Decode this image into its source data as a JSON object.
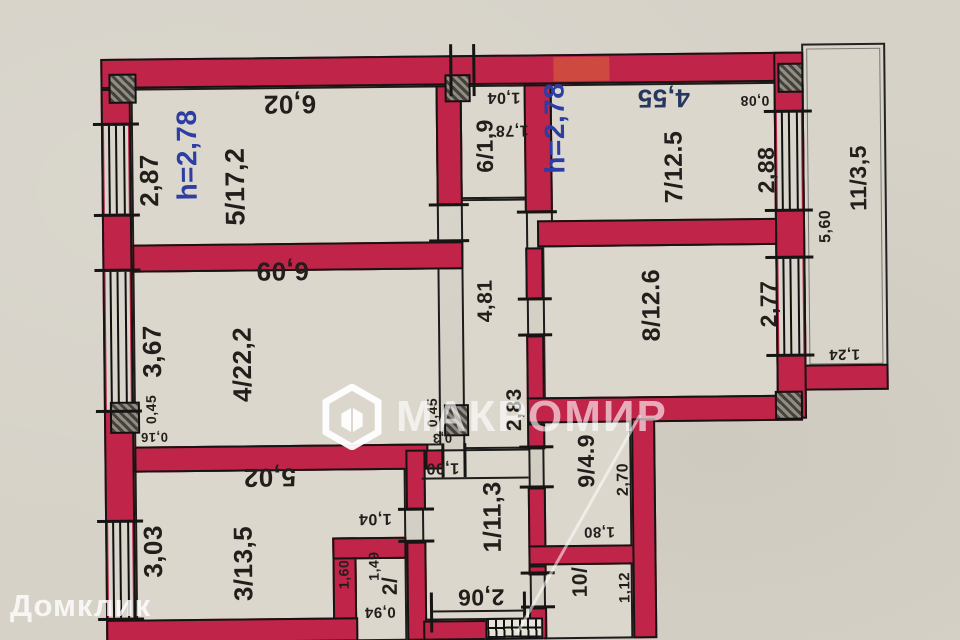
{
  "watermarks": {
    "center": "МАКРОМИР",
    "bottom_left": "Домклик"
  },
  "ceiling_height": "2,78",
  "colors": {
    "wall": "#c02449",
    "ink": "#211e1b",
    "blue": "#2c3da4",
    "navy": "#26375f",
    "paper": "#d6d2c8",
    "room": "#dbd7cc"
  },
  "rooms": [
    {
      "number": "1",
      "area": "11,3"
    },
    {
      "number": "2",
      "area": ""
    },
    {
      "number": "3",
      "area": "13,5"
    },
    {
      "number": "4",
      "area": "22,2"
    },
    {
      "number": "5",
      "area": "17,2"
    },
    {
      "number": "6",
      "area": "1,9"
    },
    {
      "number": "7",
      "area": "12.5"
    },
    {
      "number": "8",
      "area": "12.6"
    },
    {
      "number": "9",
      "area": "4.9"
    },
    {
      "number": "10",
      "area": ""
    },
    {
      "number": "11",
      "area": "3,5"
    }
  ],
  "labels": [
    {
      "name": "room-5-label",
      "text": "5/17,2",
      "x": 237,
      "y": 184,
      "rot": -90,
      "size": 27
    },
    {
      "name": "dim-room5-width",
      "text": "6,02",
      "x": 292,
      "y": 102,
      "rot": 180,
      "size": 26
    },
    {
      "name": "dim-room5-depth",
      "text": "2,87",
      "x": 151,
      "y": 177,
      "rot": -90,
      "size": 26
    },
    {
      "name": "ceiling-height-left",
      "text": "h=2,78",
      "x": 189,
      "y": 152,
      "rot": -90,
      "size": 28,
      "color": "#2c3da4"
    },
    {
      "name": "room-6-label",
      "text": "6/1,9",
      "x": 487,
      "y": 146,
      "rot": -90,
      "size": 23
    },
    {
      "name": "dim-room6-width",
      "text": "1,04",
      "x": 506,
      "y": 97,
      "rot": 180,
      "size": 16
    },
    {
      "name": "dim-room6-depth",
      "text": "1,78",
      "x": 514,
      "y": 130,
      "rot": 180,
      "size": 16
    },
    {
      "name": "ceiling-height-right",
      "text": "h=2,78",
      "x": 557,
      "y": 129,
      "rot": -90,
      "size": 28,
      "color": "#2c3da4"
    },
    {
      "name": "dim-room7-width",
      "text": "4,55",
      "x": 666,
      "y": 100,
      "rot": 180,
      "size": 26,
      "color": "#26375f"
    },
    {
      "name": "dim-0-08",
      "text": "0,08",
      "x": 757,
      "y": 104,
      "rot": 180,
      "size": 14
    },
    {
      "name": "room-7-label",
      "text": "7/12.5",
      "x": 676,
      "y": 169,
      "rot": -90,
      "size": 25
    },
    {
      "name": "dim-room7-window",
      "text": "2,88",
      "x": 768,
      "y": 173,
      "rot": -90,
      "size": 23
    },
    {
      "name": "dim-balcony-length",
      "text": "5,60",
      "x": 827,
      "y": 230,
      "rot": -90,
      "size": 16
    },
    {
      "name": "room-11-label",
      "text": "11/3,5",
      "x": 860,
      "y": 182,
      "rot": -90,
      "size": 23
    },
    {
      "name": "dim-room4-width",
      "text": "6,09",
      "x": 283,
      "y": 269,
      "rot": 180,
      "size": 26
    },
    {
      "name": "dim-room4-depth",
      "text": "3,67",
      "x": 152,
      "y": 348,
      "rot": -90,
      "size": 26
    },
    {
      "name": "room-4-label",
      "text": "4/22,2",
      "x": 242,
      "y": 362,
      "rot": -90,
      "size": 26
    },
    {
      "name": "dim-0-45-left",
      "text": "0,45",
      "x": 150,
      "y": 406,
      "rot": -90,
      "size": 14
    },
    {
      "name": "dim-0-16",
      "text": "0,16",
      "x": 153,
      "y": 434,
      "rot": 180,
      "size": 13
    },
    {
      "name": "room-8-label",
      "text": "8/12.6",
      "x": 652,
      "y": 307,
      "rot": -90,
      "size": 25
    },
    {
      "name": "dim-room8-window",
      "text": "2,77",
      "x": 769,
      "y": 307,
      "rot": -90,
      "size": 23
    },
    {
      "name": "dim-corridor-4-81",
      "text": "4,81",
      "x": 486,
      "y": 301,
      "rot": -90,
      "size": 21
    },
    {
      "name": "dim-corridor-2-83",
      "text": "2,83",
      "x": 514,
      "y": 410,
      "rot": -90,
      "size": 21
    },
    {
      "name": "dim-0-45-mid",
      "text": "0,45",
      "x": 431,
      "y": 412,
      "rot": -90,
      "size": 14
    },
    {
      "name": "dim-0-3",
      "text": "0,3",
      "x": 441,
      "y": 438,
      "rot": 180,
      "size": 13
    },
    {
      "name": "dim-1-00",
      "text": "1,00",
      "x": 441,
      "y": 467,
      "rot": 180,
      "size": 16
    },
    {
      "name": "dim-room3-width",
      "text": "5,02",
      "x": 268,
      "y": 475,
      "rot": 180,
      "size": 26
    },
    {
      "name": "dim-room3-depth",
      "text": "3,03",
      "x": 151,
      "y": 548,
      "rot": -90,
      "size": 26
    },
    {
      "name": "room-3-label",
      "text": "3/13,5",
      "x": 241,
      "y": 561,
      "rot": -90,
      "size": 26
    },
    {
      "name": "dim-1-04-door",
      "text": "1,04",
      "x": 373,
      "y": 517,
      "rot": 180,
      "size": 16
    },
    {
      "name": "dim-1-60",
      "text": "1,60",
      "x": 341,
      "y": 573,
      "rot": -90,
      "size": 14
    },
    {
      "name": "dim-1-49",
      "text": "1,49",
      "x": 371,
      "y": 565,
      "rot": -90,
      "size": 14
    },
    {
      "name": "room-2-label",
      "text": "2/",
      "x": 388,
      "y": 585,
      "rot": -90,
      "size": 21
    },
    {
      "name": "dim-0-94",
      "text": "0,94",
      "x": 377,
      "y": 611,
      "rot": 180,
      "size": 15
    },
    {
      "name": "room-1-label",
      "text": "1/11,3",
      "x": 491,
      "y": 517,
      "rot": -90,
      "size": 25
    },
    {
      "name": "dim-2-06",
      "text": "2,06",
      "x": 478,
      "y": 597,
      "rot": 180,
      "size": 23
    },
    {
      "name": "room-9-label",
      "text": "9/4.9",
      "x": 585,
      "y": 462,
      "rot": -90,
      "size": 23
    },
    {
      "name": "dim-room9-2-70",
      "text": "2,70",
      "x": 622,
      "y": 481,
      "rot": -90,
      "size": 16
    },
    {
      "name": "dim-1-80",
      "text": "1,80",
      "x": 597,
      "y": 533,
      "rot": 180,
      "size": 15
    },
    {
      "name": "room-10-label",
      "text": "10/",
      "x": 578,
      "y": 583,
      "rot": -90,
      "size": 21
    },
    {
      "name": "dim-1-12",
      "text": "1,12",
      "x": 622,
      "y": 589,
      "rot": -90,
      "size": 15
    },
    {
      "name": "dim-balcony-1-24",
      "text": "1,24",
      "x": 844,
      "y": 358,
      "rot": 180,
      "size": 15
    }
  ]
}
